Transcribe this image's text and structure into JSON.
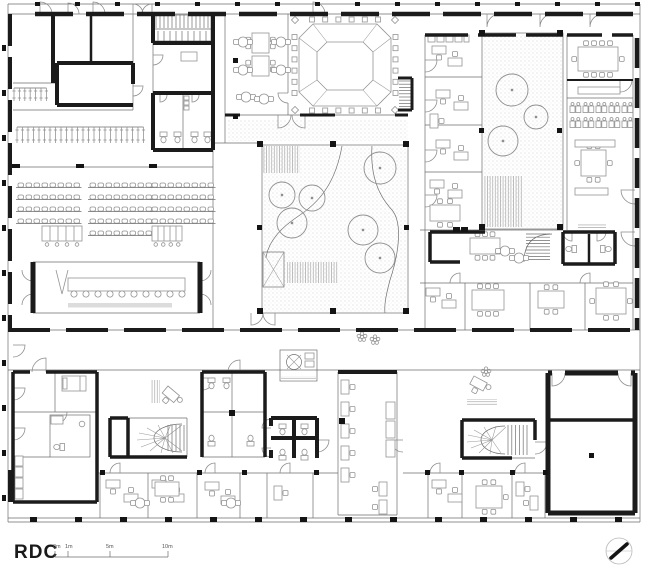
{
  "labels": {
    "floor": "RDC"
  },
  "scalebar": {
    "y": 557,
    "x0": 55,
    "x1": 168,
    "ticks": [
      {
        "t": "0m",
        "x": 55
      },
      {
        "t": "1m",
        "x": 68
      },
      {
        "t": "5m",
        "x": 110
      },
      {
        "t": "10m",
        "x": 168
      }
    ]
  },
  "north_icon": {
    "cx": 619,
    "cy": 551,
    "r": 13
  },
  "colors": {
    "wall": "#1b1b1b",
    "thin_line": "#6e6e6e",
    "furniture": "#949494",
    "stipple": "#c6c6c6",
    "platform_strip": "#dcdcdc",
    "paper": "#ffffff"
  },
  "plan": {
    "trees_main": [
      [
        282,
        195,
        13
      ],
      [
        312,
        198,
        13
      ],
      [
        292,
        223,
        15
      ],
      [
        380,
        168,
        16
      ],
      [
        363,
        230,
        15
      ],
      [
        380,
        258,
        15
      ]
    ],
    "trees_right": [
      [
        512,
        90,
        16
      ],
      [
        536,
        117,
        12
      ],
      [
        503,
        141,
        15
      ]
    ],
    "auditorium": {
      "seat_w": 5.5,
      "step": 8,
      "rows": [
        {
          "y": 183,
          "groups": [
            [
              18,
              8
            ],
            [
              90,
              8
            ],
            [
              152,
              8
            ]
          ]
        },
        {
          "y": 195,
          "groups": [
            [
              18,
              8
            ],
            [
              90,
              8
            ],
            [
              152,
              8
            ]
          ]
        },
        {
          "y": 207,
          "groups": [
            [
              18,
              8
            ],
            [
              90,
              8
            ],
            [
              152,
              8
            ]
          ]
        },
        {
          "y": 219,
          "groups": [
            [
              18,
              8
            ],
            [
              90,
              8
            ],
            [
              152,
              8
            ]
          ]
        },
        {
          "y": 231,
          "groups": [
            [
              90,
              8
            ]
          ]
        }
      ],
      "consoles": [
        [
          42,
          226,
          40,
          15
        ],
        [
          152,
          226,
          30,
          15
        ]
      ]
    },
    "council": {
      "table": [
        68,
        278,
        117,
        13
      ],
      "chairs_y": 294,
      "chairs_x0": 74,
      "chairs_n": 10,
      "chairs_step": 12,
      "strip": [
        68,
        303,
        104,
        4.5
      ]
    },
    "ring": {
      "outer": [
        299,
        24,
        92,
        82
      ],
      "inner": [
        317,
        42,
        56,
        46
      ],
      "chairs_per_side": 6
    },
    "classroom": {
      "x0": 570,
      "step": 13,
      "pairs": 5,
      "rows": [
        106,
        121
      ]
    },
    "hooks": [
      {
        "x": 14,
        "y": 88,
        "n": 7,
        "step": 5.4,
        "len": 13
      },
      {
        "x": 17,
        "y": 127,
        "n": 24,
        "step": 5.5,
        "len": 16
      }
    ],
    "desks": [
      [
        432,
        46,
        0
      ],
      [
        448,
        58,
        2
      ],
      [
        436,
        90,
        0
      ],
      [
        454,
        102,
        2
      ],
      [
        430,
        114,
        1
      ],
      [
        436,
        140,
        0
      ],
      [
        454,
        152,
        2
      ],
      [
        430,
        180,
        0
      ],
      [
        448,
        190,
        2
      ],
      [
        426,
        288,
        0
      ],
      [
        442,
        300,
        2
      ],
      [
        341,
        380,
        1
      ],
      [
        341,
        402,
        1
      ],
      [
        341,
        424,
        1
      ],
      [
        341,
        446,
        1
      ],
      [
        341,
        468,
        1
      ],
      [
        379,
        482,
        3
      ],
      [
        379,
        500,
        3
      ],
      [
        106,
        480,
        0
      ],
      [
        124,
        494,
        2
      ],
      [
        152,
        480,
        0
      ],
      [
        170,
        494,
        2
      ],
      [
        205,
        482,
        0
      ],
      [
        221,
        496,
        2
      ],
      [
        274,
        486,
        1
      ],
      [
        432,
        480,
        0
      ],
      [
        448,
        494,
        2
      ],
      [
        516,
        482,
        1
      ],
      [
        530,
        496,
        3
      ]
    ],
    "desk_angled": [
      [
        168,
        386,
        40
      ],
      [
        474,
        376,
        28
      ]
    ],
    "round_tables": [
      [
        243,
        42
      ],
      [
        243,
        70
      ],
      [
        281,
        42
      ],
      [
        281,
        70
      ],
      [
        246,
        97
      ],
      [
        264,
        99
      ],
      [
        505,
        251
      ],
      [
        519,
        258
      ],
      [
        140,
        503
      ],
      [
        231,
        503
      ]
    ],
    "meeting_tables": [
      {
        "x": 578,
        "y": 47,
        "w": 40,
        "h": 24,
        "t": 4,
        "b": 4,
        "l": 1,
        "r": 1
      },
      {
        "x": 581,
        "y": 150,
        "w": 25,
        "h": 26,
        "t": 2,
        "b": 2,
        "l": 1,
        "r": 1
      },
      {
        "x": 596,
        "y": 288,
        "w": 30,
        "h": 26,
        "t": 2,
        "b": 2,
        "l": 1,
        "r": 1
      },
      {
        "x": 538,
        "y": 291,
        "w": 26,
        "h": 17,
        "t": 2,
        "b": 2,
        "l": 0,
        "r": 0
      },
      {
        "x": 470,
        "y": 238,
        "w": 30,
        "h": 16,
        "t": 3,
        "b": 3,
        "l": 0,
        "r": 0
      },
      {
        "x": 472,
        "y": 290,
        "w": 32,
        "h": 20,
        "t": 3,
        "b": 3,
        "l": 0,
        "r": 0
      },
      {
        "x": 476,
        "y": 486,
        "w": 26,
        "h": 22,
        "t": 2,
        "b": 2,
        "l": 0,
        "r": 1
      },
      {
        "x": 430,
        "y": 205,
        "w": 30,
        "h": 16,
        "t": 2,
        "b": 2,
        "l": 0,
        "r": 0
      },
      {
        "x": 252,
        "y": 33,
        "w": 17,
        "h": 20,
        "t": 0,
        "b": 0,
        "l": 2,
        "r": 2
      },
      {
        "x": 252,
        "y": 56,
        "w": 17,
        "h": 20,
        "t": 0,
        "b": 0,
        "l": 2,
        "r": 2
      },
      {
        "x": 155,
        "y": 482,
        "w": 24,
        "h": 14,
        "t": 2,
        "b": 2,
        "l": 0,
        "r": 0
      }
    ],
    "long_tables": [
      [
        578,
        87,
        42,
        7
      ],
      [
        575,
        140,
        40,
        7
      ],
      [
        575,
        188,
        33,
        7
      ],
      [
        181,
        52,
        16,
        9
      ],
      [
        386,
        402,
        9,
        17
      ],
      [
        386,
        421,
        9,
        17
      ],
      [
        386,
        440,
        9,
        17
      ],
      [
        15,
        456,
        8,
        10
      ],
      [
        15,
        467,
        8,
        10
      ],
      [
        15,
        478,
        8,
        10
      ],
      [
        15,
        489,
        8,
        10
      ],
      [
        428,
        35,
        7,
        7
      ],
      [
        437,
        35,
        7,
        7
      ],
      [
        446,
        35,
        7,
        7
      ],
      [
        455,
        35,
        7,
        7
      ],
      [
        464,
        35,
        5,
        7
      ]
    ],
    "toilets": [
      [
        160,
        132,
        0
      ],
      [
        174,
        132,
        0
      ],
      [
        191,
        132,
        0
      ],
      [
        204,
        132,
        0
      ],
      [
        568,
        244,
        1
      ],
      [
        602,
        244,
        3
      ],
      [
        279,
        424,
        0
      ],
      [
        301,
        424,
        0
      ],
      [
        279,
        450,
        2
      ],
      [
        301,
        450,
        2
      ],
      [
        208,
        378,
        0
      ],
      [
        223,
        378,
        0
      ],
      [
        208,
        436,
        2
      ],
      [
        247,
        436,
        2
      ],
      [
        56,
        442,
        1
      ]
    ],
    "plants": [
      [
        362,
        337
      ],
      [
        486,
        372
      ],
      [
        375,
        340
      ]
    ],
    "posts": [
      [
        257,
        141,
        6,
        6
      ],
      [
        330,
        141,
        6,
        6
      ],
      [
        403,
        141,
        6,
        6
      ],
      [
        257,
        225,
        5,
        5
      ],
      [
        404,
        225,
        5,
        5
      ],
      [
        257,
        308,
        6,
        6
      ],
      [
        330,
        308,
        6,
        6
      ],
      [
        403,
        308,
        6,
        6
      ],
      [
        479,
        30,
        6,
        6
      ],
      [
        557,
        30,
        6,
        6
      ],
      [
        479,
        128,
        5,
        5
      ],
      [
        557,
        128,
        5,
        5
      ],
      [
        479,
        224,
        6,
        6
      ],
      [
        557,
        224,
        6,
        6
      ],
      [
        233,
        58,
        5,
        5
      ],
      [
        233,
        114,
        5,
        5
      ],
      [
        339,
        418,
        6,
        6
      ],
      [
        589,
        453,
        5,
        5
      ],
      [
        229,
        410,
        6,
        6
      ],
      [
        453,
        227,
        7,
        5
      ],
      [
        461,
        227,
        7,
        5
      ],
      [
        12,
        164,
        8,
        4
      ],
      [
        76,
        164,
        8,
        4
      ],
      [
        149,
        164,
        8,
        4
      ],
      [
        100,
        470,
        5,
        5
      ],
      [
        197,
        470,
        5,
        5
      ],
      [
        242,
        470,
        5,
        5
      ],
      [
        314,
        470,
        5,
        5
      ],
      [
        425,
        470,
        5,
        5
      ],
      [
        459,
        470,
        5,
        5
      ],
      [
        510,
        470,
        5,
        5
      ],
      [
        543,
        470,
        5,
        5
      ]
    ],
    "ticks": {
      "top": {
        "y": 2,
        "x0": 35,
        "x1": 635,
        "step": 40,
        "w": 5,
        "h": 4
      },
      "bottom": {
        "y": 517,
        "x0": 30,
        "x1": 640,
        "step": 45,
        "w": 7,
        "h": 5
      },
      "left": {
        "x": 2,
        "y0": 45,
        "y1": 505,
        "step": 45,
        "w": 4,
        "h": 6
      }
    },
    "tread_runs": [
      {
        "vert": true,
        "x0": 156,
        "x1": 208,
        "step": 4,
        "y0": 15,
        "y1": 28
      },
      {
        "vert": true,
        "x0": 158,
        "x1": 206,
        "step": 6,
        "y0": 31,
        "y1": 41
      },
      {
        "vert": false,
        "y0": 81,
        "y1": 107,
        "step": 3.2,
        "x0": 399,
        "x1": 411
      },
      {
        "vert": false,
        "y0": 234,
        "y1": 260,
        "step": 3.2,
        "x0": 526,
        "x1": 550
      },
      {
        "vert": true,
        "x0": 508,
        "x1": 530,
        "step": 3.8,
        "y0": 425,
        "y1": 455
      },
      {
        "vert": true,
        "x0": 168,
        "x1": 184,
        "step": 4,
        "y0": 425,
        "y1": 451
      }
    ]
  }
}
